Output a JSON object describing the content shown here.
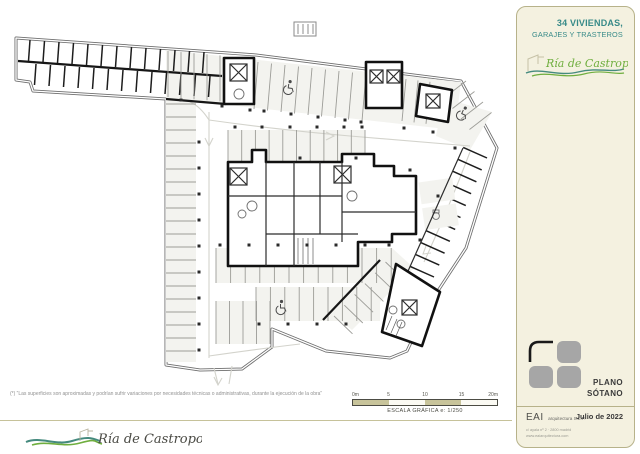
{
  "header": {
    "project_title_line1": "34 VIVIENDAS,",
    "project_title_line2": "GARAJES Y TRASTEROS",
    "brand_name": "Ría de Castropol"
  },
  "plan": {
    "drawing_type": "basement parking floor plan",
    "icons": [
      "wheelchair-accessible-parking",
      "elevator-shaft",
      "stairs",
      "driving-aisle-arrows",
      "toilet-fixture"
    ]
  },
  "scale_bar": {
    "tick_labels": [
      "0m",
      "5",
      "10",
      "15",
      "20m"
    ],
    "caption": "ESCALA GRÁFICA e: 1/250"
  },
  "notes": {
    "disclaimer": "(*) “Las superficies son aproximadas y podrían sufrir variaciones por necesidades técnicas o administrativas, durante la ejecución de la obra”"
  },
  "footer": {
    "brand_name": "Ría de Castropol"
  },
  "title_block": {
    "sheet_name_line1": "PLANO",
    "sheet_name_line2": "SÓTANO",
    "firm_abbr": "EAI",
    "firm_desc": "arquitectura S.L.P.",
    "firm_address": "c/ ayala nº 2 · 2800 madrid",
    "firm_contact": "www.eaiarquitectura.com",
    "date": "Julio de 2022"
  },
  "colors": {
    "accent_teal": "#378a88",
    "brand_green": "#7cb23f",
    "panel_bg": "#f4f1e0",
    "panel_border": "#b7b28a",
    "wall": "#161616",
    "stall_fill": "#f3f3ef",
    "aisle_line": "#d3d3cc",
    "scale_khaki": "#c8c49b"
  }
}
